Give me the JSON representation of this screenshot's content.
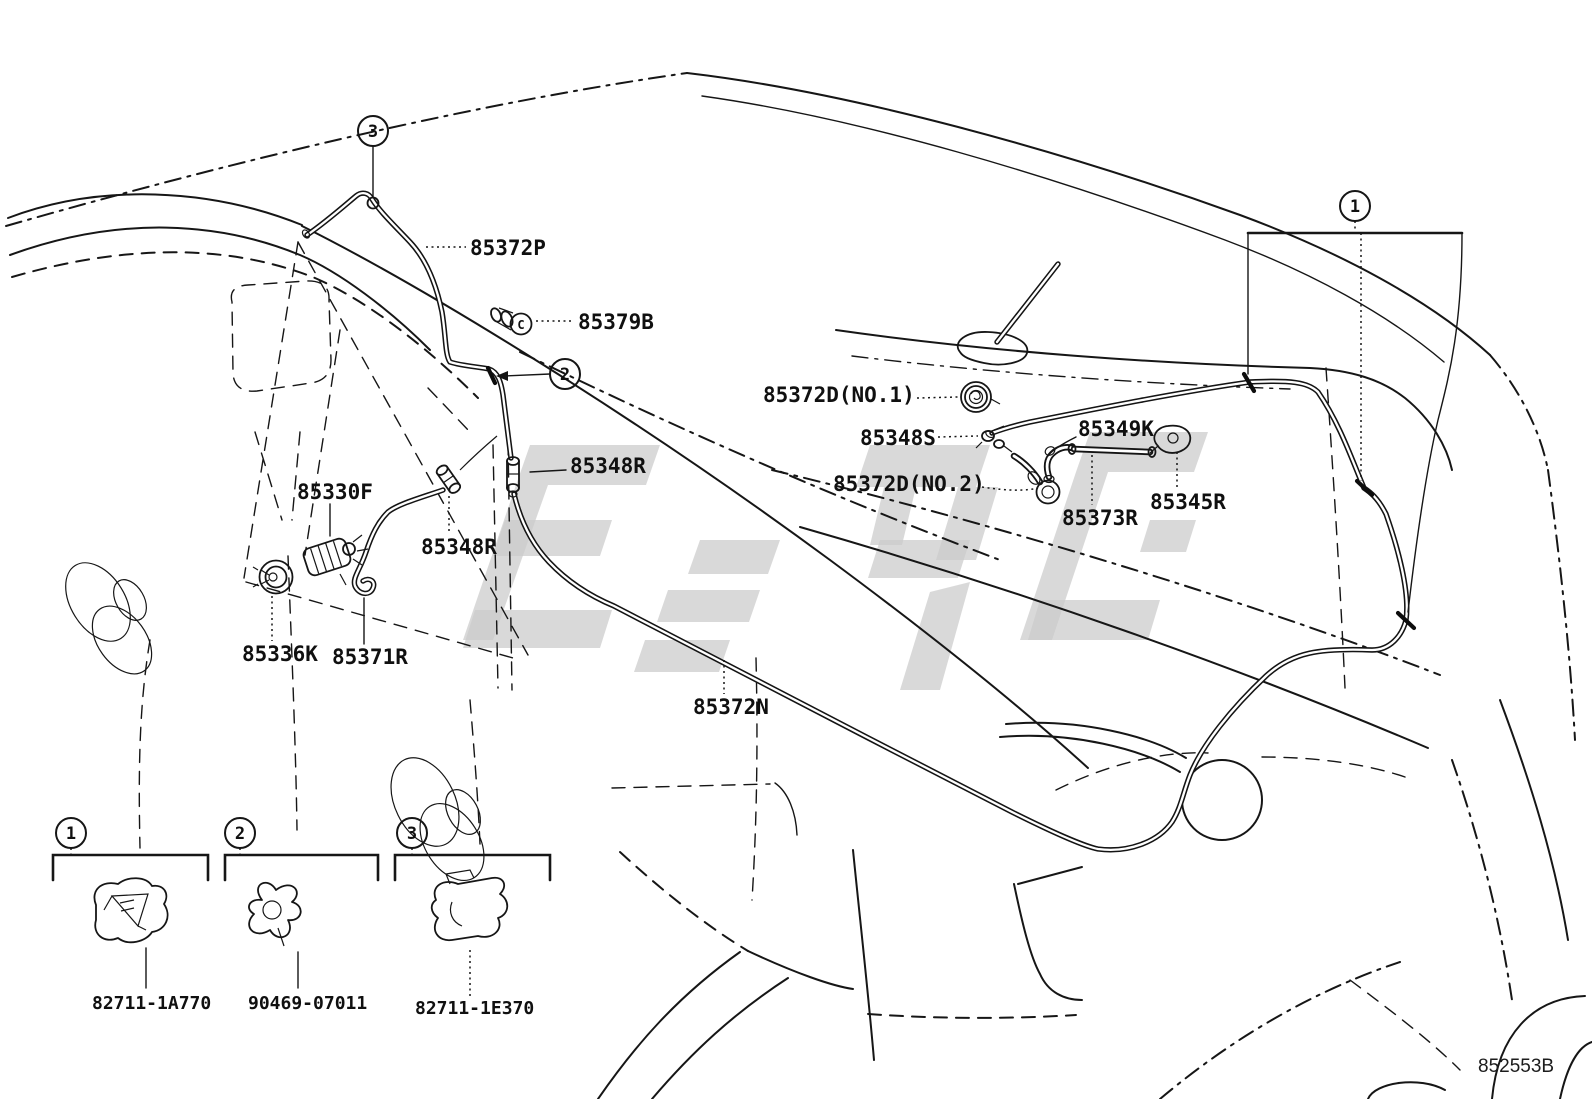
{
  "diagram": {
    "code": "852553B",
    "c_marker": "C",
    "callouts": {
      "c1": "1",
      "c2": "2",
      "c3": "3"
    },
    "labels": {
      "p85372P": "85372P",
      "p85379B": "85379B",
      "p85372D_no1": "85372D(NO.1)",
      "p85348S": "85348S",
      "p85349K": "85349K",
      "p85372D_no2": "85372D(NO.2)",
      "p85373R": "85373R",
      "p85345R": "85345R",
      "p85348R_a": "85348R",
      "p85348R_b": "85348R",
      "p85330F": "85330F",
      "p85336K": "85336K",
      "p85371R": "85371R",
      "p85372N": "85372N"
    },
    "legend": [
      {
        "callout": "1",
        "part_number": "82711-1A770"
      },
      {
        "callout": "2",
        "part_number": "90469-07011"
      },
      {
        "callout": "3",
        "part_number": "82711-1E370"
      }
    ]
  }
}
